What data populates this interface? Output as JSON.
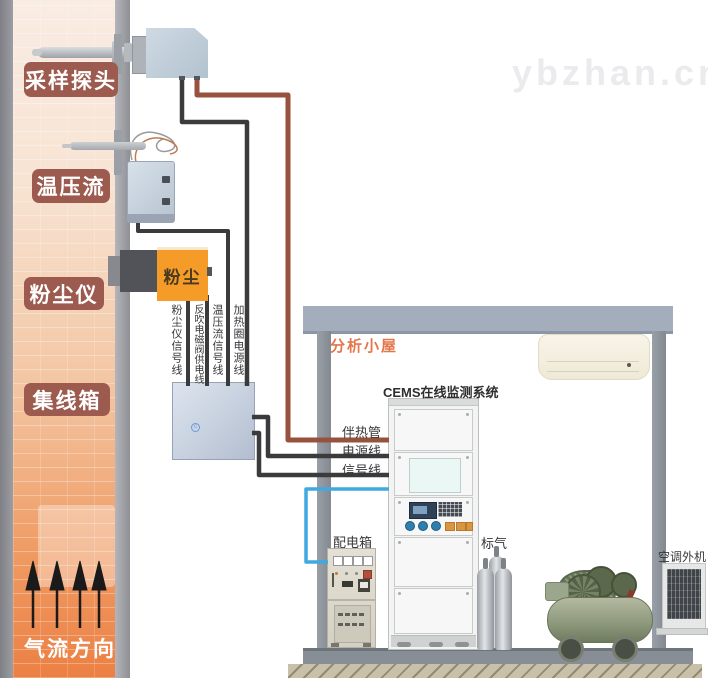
{
  "watermark": "ybzhan.cn",
  "stack": {
    "sampling_probe": "采样探头",
    "temp_pressure_flow": "温压流",
    "dust_meter": "粉尘仪",
    "junction_box": "集线箱",
    "airflow_direction": "气流方向",
    "dust_device_text": "粉尘"
  },
  "cables": {
    "dust_signal": "粉尘仪信号线",
    "blowback_power": "反吹电磁阀供电线",
    "tpf_signal": "温压流信号线",
    "heater_power": "加热圈电源线",
    "heat_trace": "伴热管",
    "power": "电源线",
    "signal": "信号线"
  },
  "shelter": {
    "title": "分析小屋",
    "cems_system": "CEMS在线监测系统",
    "power_box": "配电箱",
    "standard_gas": "标气",
    "ac_outdoor": "空调外机"
  },
  "colors": {
    "stack_top": "#f9ece2",
    "stack_bottom": "#ee8144",
    "label_plate": "#9d5a4e",
    "heat_trace_wire": "#96523d",
    "signal_wire": "#3b3b3d",
    "blue_wire": "#3fa9e1",
    "dust_meter_orange": "#f59b28",
    "shelter_frame": "#a3adbc",
    "shelter_title": "#e4764a"
  }
}
